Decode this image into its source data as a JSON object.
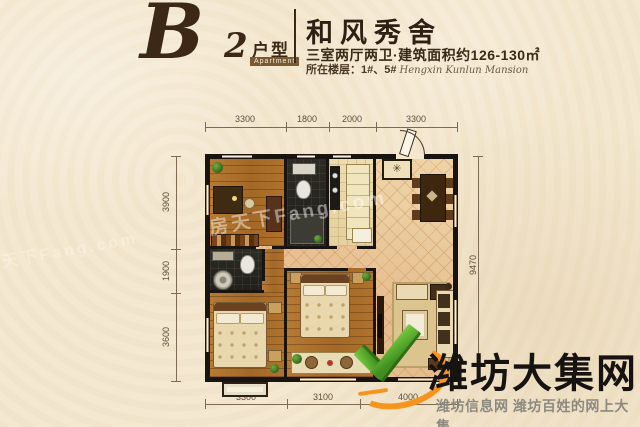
{
  "header": {
    "unit_code": {
      "letter": "B",
      "number": "2"
    },
    "unit_label": "户型",
    "unit_label_en": "Apartment",
    "project_title": "和风秀舍",
    "spec_line": "三室两厅两卫·建筑面积约126-130㎡",
    "floor_line": "所在楼层：1#、5#",
    "floor_line_en": "Hengxin Kunlun Mansion"
  },
  "plan": {
    "dims_top": [
      "3300",
      "1800",
      "2000",
      "3300"
    ],
    "dims_left": [
      "3900",
      "1900",
      "3600"
    ],
    "dims_bottom": [
      "3300",
      "3100",
      "4000"
    ],
    "dim_right": "9470",
    "medallion_glyph": "✳"
  },
  "watermarks": {
    "site_name": "潍坊大集网",
    "site_tagline": "潍坊信息网 潍坊百姓的网上大集",
    "photo_watermark": "房天下Fang.com"
  },
  "colors": {
    "accent_brown": "#3c2817",
    "logo_green": "#4fa32a",
    "logo_orange": "#f7941d",
    "wall_black": "#1a1410",
    "wood_floor": "#ad7230",
    "tile_floor": "#e7c897",
    "bath_dark": "#26241e",
    "background_cream": "#f3e7ce"
  }
}
